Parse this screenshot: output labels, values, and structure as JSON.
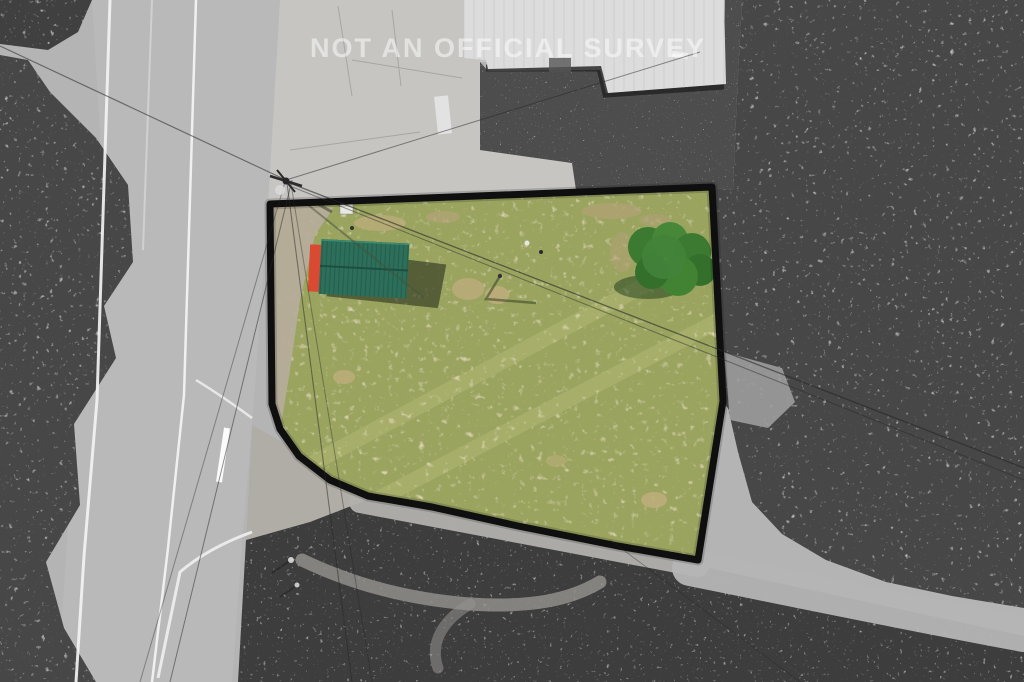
{
  "image": {
    "watermark_text": "NOT AN OFFICIAL SURVEY",
    "description": "Aerial drone photo: property parcel shown in color with thick black boundary over grayscale surroundings"
  },
  "colors": {
    "boundary": "#0f0f0f",
    "parcel_grass": "#9aa45e",
    "shed_roof_green": "#2d6f5a",
    "shed_end_red": "#da4a33",
    "bush_green": "#42823a",
    "bare_patch_tan": "#b9ab79",
    "road_gray": "#b9b9b9",
    "concrete_gray": "#c6c5c2",
    "asphalt_dark": "#4d4d4d",
    "trees_dark": "#464646",
    "field_dark": "#3c3c3c",
    "gravel_light": "#b2b0ac",
    "building_roof": "#dcdcdc",
    "road_marking_white": "#f2f2f2",
    "watermark_white": "#ffffff"
  },
  "scene": {
    "parcel_label": "highlighted parcel (color)",
    "shed_label": "green metal-roof shed with red end",
    "building_label": "warehouse roof",
    "road_label": "paved road",
    "gravel_road_label": "gravel drive",
    "trees_label": "tree canopy",
    "field_label": "mowed dark field"
  }
}
